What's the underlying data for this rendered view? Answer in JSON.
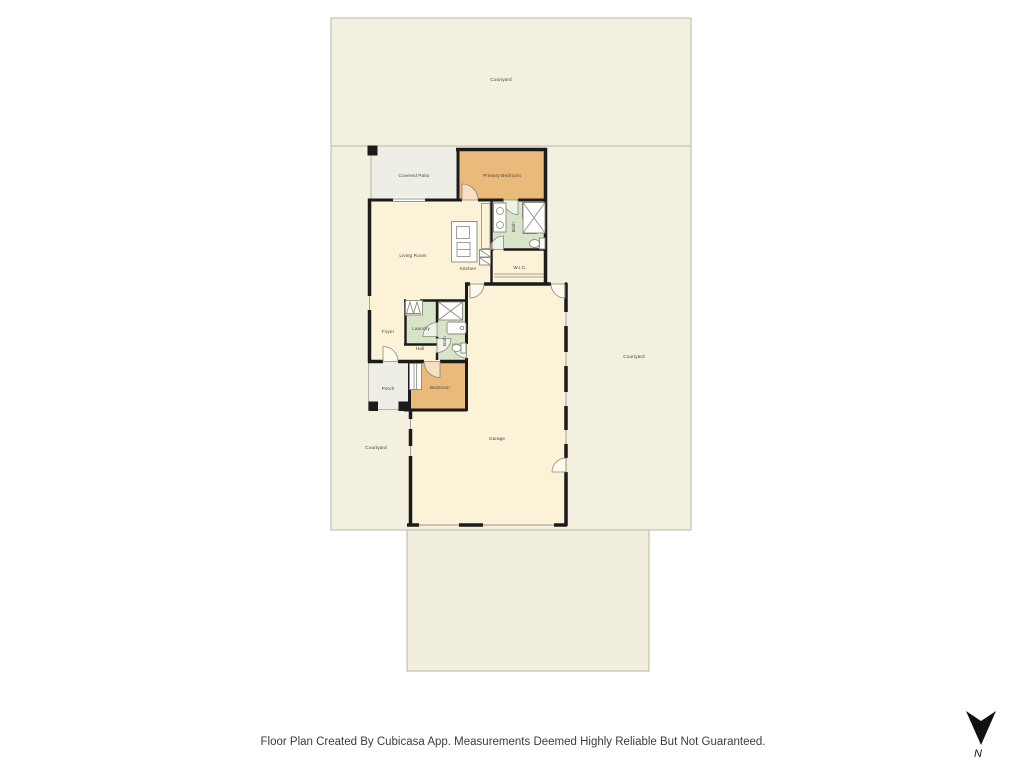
{
  "colors": {
    "page-bg": "#ffffff",
    "courtyard-fill": "#f3f0e0",
    "courtyard-border": "#b9b6a6",
    "driveway-fill": "#f1eede",
    "interior-fill": "#fbf2d8",
    "bedroom-fill": "#eaba7a",
    "bath-fill": "#d8e4c8",
    "patio-fill": "#efeee6",
    "wall-color": "#1b1b1b",
    "fixture-stroke": "#8b8878",
    "label-color": "#46463c",
    "footer-color": "#3c3c3c",
    "north-color": "#111111"
  },
  "floor_plan": {
    "labels": {
      "courtyard_top": "Courtyard",
      "courtyard_right": "Courtyard",
      "courtyard_left": "Courtyard",
      "covered_patio": "Covered Patio",
      "primary_bedroom": "Primary Bedroom",
      "living_room": "Living Room",
      "kitchen": "Kitchen",
      "primary_bath": "Bath",
      "wic": "W.I.C.",
      "foyer": "Foyer",
      "laundry": "Laundry",
      "hall": "Hall",
      "hall_bath": "Bath",
      "porch": "Porch",
      "bedroom": "Bedroom",
      "garage": "Garage"
    }
  },
  "footer": {
    "disclaimer": "Floor Plan Created By Cubicasa App. Measurements Deemed Highly Reliable But Not Guaranteed."
  },
  "compass": {
    "label": "N"
  }
}
